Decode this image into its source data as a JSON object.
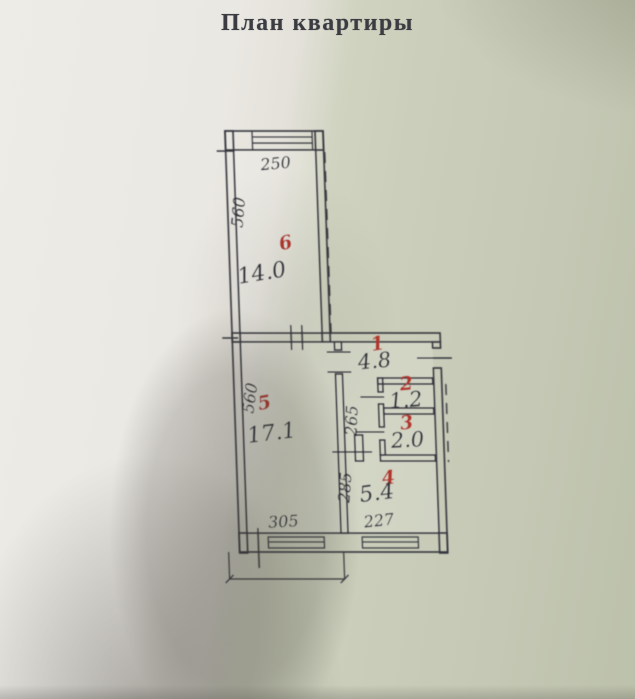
{
  "title": "План квартиры",
  "rooms": {
    "r1": {
      "number": "1",
      "area": "4.8"
    },
    "r2": {
      "number": "2",
      "area": "1.2"
    },
    "r3": {
      "number": "3",
      "area": "2.0"
    },
    "r4": {
      "number": "4",
      "area": "5.4"
    },
    "r5": {
      "number": "5",
      "area": "17.1"
    },
    "r6": {
      "number": "6",
      "area": "14.0"
    }
  },
  "dimensions": {
    "room6_width": "250",
    "room6_depth": "560",
    "room5_depth": "560",
    "room5_width": "305",
    "hall_depth": "265",
    "kitchen_depth": "285",
    "kitchen_width": "227"
  },
  "colors": {
    "ink": "#34363e",
    "room_number_red": "#b2342a",
    "paper_light": "#edece7",
    "paper_shaded": "#c4c8b4"
  }
}
